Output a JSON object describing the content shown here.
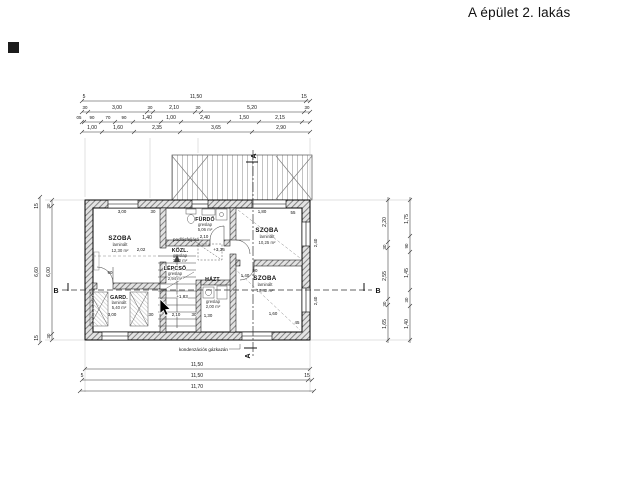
{
  "title": "A épület 2. lakás",
  "section_markers": {
    "a": "A",
    "b": "B"
  },
  "levels": {
    "upper": "+3,35",
    "stair": "+1,83"
  },
  "notes": {
    "boiler": "kondenzációs gázkazán",
    "attic_access": "padlásfeljáró"
  },
  "rooms": {
    "szoba_tl": {
      "name": "SZOBA",
      "floor": "laminált",
      "area": "12,30 m²"
    },
    "furdo": {
      "name": "FÜRDŐ",
      "floor": "greslap",
      "area": "5,06 m²"
    },
    "kozl": {
      "name": "KÖZL.",
      "floor": "greslap",
      "area": "3,90 m²"
    },
    "szoba_tr": {
      "name": "SZOBA",
      "floor": "laminált",
      "area": "10,25 m²"
    },
    "lepcso": {
      "name": "LÉPCSŐ",
      "floor": "greslap",
      "area": "2,94 m²"
    },
    "gard": {
      "name": "GARD.",
      "floor": "laminált",
      "area": "5,40 m²"
    },
    "hazt": {
      "name": "HÁZT.",
      "floor": "greslap",
      "area": "2,00 m²"
    },
    "szoba_br": {
      "name": "SZOBA",
      "floor": "laminált",
      "area": "10,42 m²"
    }
  },
  "dims": {
    "top": {
      "row1": [
        "5",
        "11,50",
        "15"
      ],
      "row2": [
        "30",
        "3,00",
        "30",
        "2,10",
        "30",
        "5,20",
        "30"
      ],
      "row3": [
        "05",
        "90",
        "70",
        "90",
        "1,40",
        "1,00",
        "2,40",
        "1,50",
        "2,15"
      ],
      "row4": [
        "1,00",
        "1,60",
        "2,35",
        "3,65",
        "2,90"
      ]
    },
    "bottom": [
      "11,50",
      "5",
      "11,50",
      "15",
      "11,70"
    ],
    "left": {
      "outer": [
        "15",
        "6,60",
        "15"
      ],
      "inner": [
        "30",
        "6,00",
        "30"
      ]
    },
    "right": {
      "inner": [
        "2,20",
        "30",
        "2,55",
        "30",
        "1,65"
      ],
      "outer": [
        "1,75",
        "90",
        "1,45",
        "30",
        "1,40"
      ]
    },
    "plan": [
      "3,00",
      "30",
      "1,80",
      "90",
      "2,02",
      "2,10",
      "30",
      "3,00",
      "30",
      "1,60",
      "45",
      "1,40",
      "90",
      "2,40",
      "2,40",
      "1,30",
      "2,10",
      "55"
    ]
  }
}
